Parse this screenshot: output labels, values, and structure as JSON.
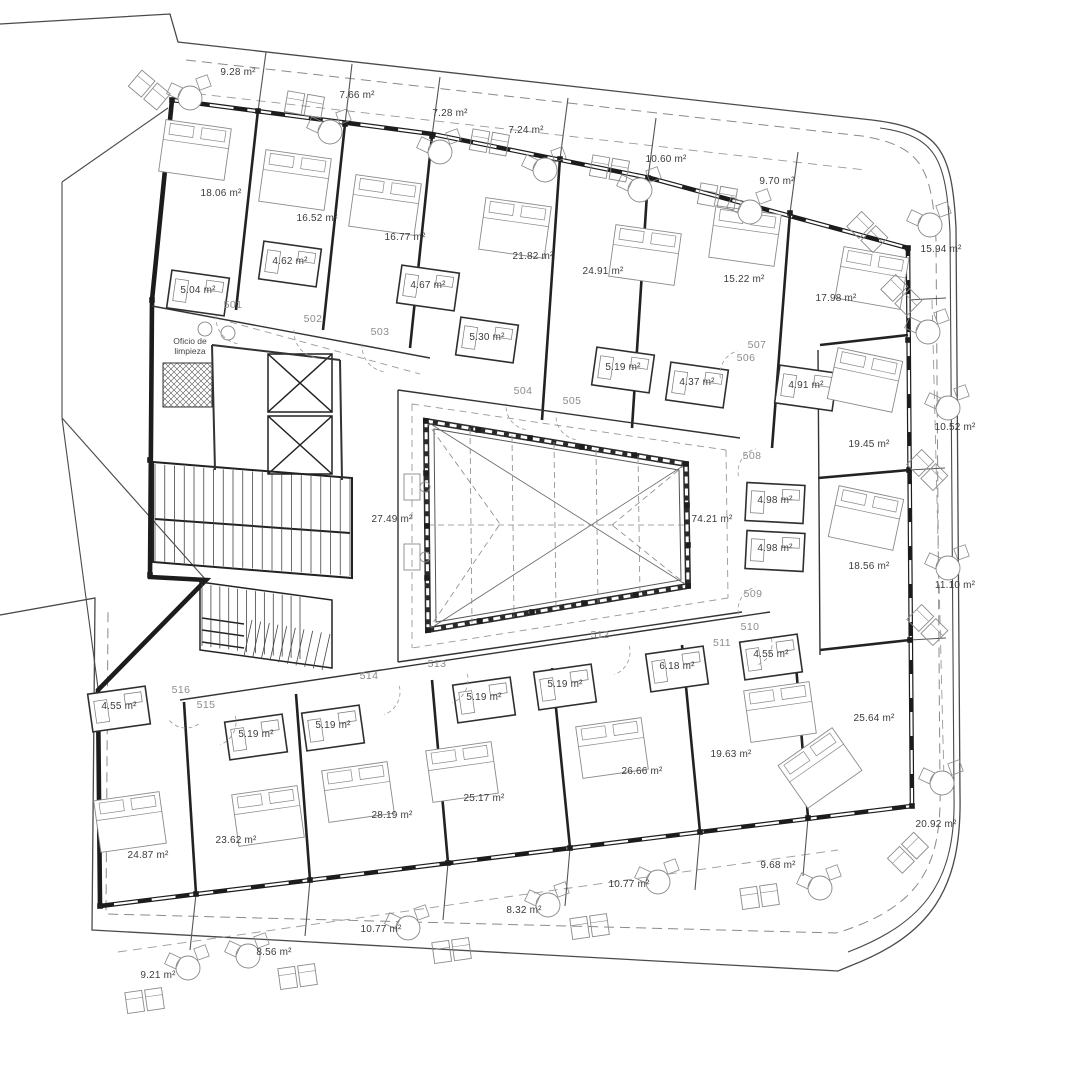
{
  "plan": {
    "canvas": {
      "width": 1072,
      "height": 1080,
      "background": "#ffffff",
      "ink": "#1c1c1c",
      "annotation_color": "#3c3c3c",
      "room_number_color": "#8c8c8c"
    },
    "annotations": {
      "cleaning_room": [
        "Oficio de",
        "limpieza"
      ],
      "area_labels": [
        {
          "t": "9.28 m²",
          "x": 238,
          "y": 75
        },
        {
          "t": "7.66 m²",
          "x": 357,
          "y": 98
        },
        {
          "t": "7.28 m²",
          "x": 450,
          "y": 116
        },
        {
          "t": "7.24 m²",
          "x": 526,
          "y": 133
        },
        {
          "t": "10.60 m²",
          "x": 666,
          "y": 162
        },
        {
          "t": "9.70 m²",
          "x": 777,
          "y": 184
        },
        {
          "t": "15.94 m²",
          "x": 941,
          "y": 252
        },
        {
          "t": "18.06 m²",
          "x": 221,
          "y": 196
        },
        {
          "t": "16.52 m²",
          "x": 317,
          "y": 221
        },
        {
          "t": "16.77 m²",
          "x": 405,
          "y": 240
        },
        {
          "t": "21.82 m²",
          "x": 533,
          "y": 259
        },
        {
          "t": "24.91 m²",
          "x": 603,
          "y": 274
        },
        {
          "t": "15.22 m²",
          "x": 744,
          "y": 282
        },
        {
          "t": "17.98 m²",
          "x": 836,
          "y": 301
        },
        {
          "t": "4.62 m²",
          "x": 290,
          "y": 264
        },
        {
          "t": "5.04 m²",
          "x": 198,
          "y": 293
        },
        {
          "t": "4.67 m²",
          "x": 428,
          "y": 288
        },
        {
          "t": "5.30 m²",
          "x": 487,
          "y": 340
        },
        {
          "t": "5.19 m²",
          "x": 623,
          "y": 370
        },
        {
          "t": "4.37 m²",
          "x": 697,
          "y": 385
        },
        {
          "t": "4.91 m²",
          "x": 806,
          "y": 388
        },
        {
          "t": "19.45 m²",
          "x": 869,
          "y": 447
        },
        {
          "t": "10.52 m²",
          "x": 955,
          "y": 430
        },
        {
          "t": "4.98 m²",
          "x": 775,
          "y": 503
        },
        {
          "t": "4.98 m²",
          "x": 775,
          "y": 551
        },
        {
          "t": "18.56 m²",
          "x": 869,
          "y": 569
        },
        {
          "t": "11.10 m²",
          "x": 955,
          "y": 588
        },
        {
          "t": "27.49 m²",
          "x": 392,
          "y": 522
        },
        {
          "t": "74.21 m²",
          "x": 712,
          "y": 522
        },
        {
          "t": "6.18 m²",
          "x": 677,
          "y": 669
        },
        {
          "t": "4.55 m²",
          "x": 771,
          "y": 657
        },
        {
          "t": "4.55 m²",
          "x": 119,
          "y": 709
        },
        {
          "t": "5.19 m²",
          "x": 256,
          "y": 737
        },
        {
          "t": "5.19 m²",
          "x": 333,
          "y": 728
        },
        {
          "t": "5.19 m²",
          "x": 484,
          "y": 700
        },
        {
          "t": "5.19 m²",
          "x": 565,
          "y": 687
        },
        {
          "t": "25.64 m²",
          "x": 874,
          "y": 721
        },
        {
          "t": "19.63 m²",
          "x": 731,
          "y": 757
        },
        {
          "t": "26.66 m²",
          "x": 642,
          "y": 774
        },
        {
          "t": "25.17 m²",
          "x": 484,
          "y": 801
        },
        {
          "t": "28.19 m²",
          "x": 392,
          "y": 818
        },
        {
          "t": "23.62 m²",
          "x": 236,
          "y": 843
        },
        {
          "t": "24.87 m²",
          "x": 148,
          "y": 858
        },
        {
          "t": "20.92 m²",
          "x": 936,
          "y": 827
        },
        {
          "t": "9.68 m²",
          "x": 778,
          "y": 868
        },
        {
          "t": "10.77 m²",
          "x": 629,
          "y": 887
        },
        {
          "t": "8.32 m²",
          "x": 524,
          "y": 913
        },
        {
          "t": "10.77 m²",
          "x": 381,
          "y": 932
        },
        {
          "t": "8.56 m²",
          "x": 274,
          "y": 955
        },
        {
          "t": "9.21 m²",
          "x": 158,
          "y": 978
        }
      ],
      "room_numbers": [
        {
          "t": "501",
          "x": 233,
          "y": 308
        },
        {
          "t": "502",
          "x": 313,
          "y": 322
        },
        {
          "t": "503",
          "x": 380,
          "y": 335
        },
        {
          "t": "504",
          "x": 523,
          "y": 394
        },
        {
          "t": "505",
          "x": 572,
          "y": 404
        },
        {
          "t": "506",
          "x": 746,
          "y": 361
        },
        {
          "t": "507",
          "x": 757,
          "y": 348
        },
        {
          "t": "508",
          "x": 752,
          "y": 459
        },
        {
          "t": "509",
          "x": 753,
          "y": 597
        },
        {
          "t": "510",
          "x": 750,
          "y": 630
        },
        {
          "t": "511",
          "x": 722,
          "y": 646
        },
        {
          "t": "512",
          "x": 600,
          "y": 638
        },
        {
          "t": "513",
          "x": 437,
          "y": 667
        },
        {
          "t": "514",
          "x": 369,
          "y": 679
        },
        {
          "t": "515",
          "x": 206,
          "y": 708
        },
        {
          "t": "516",
          "x": 181,
          "y": 693
        }
      ]
    },
    "geometry": {
      "paths": [
        {
          "d": "M0,24 L170,14 L178,42 L872,120 C940,128 952,150 956,228 L960,795 C962,890 930,935 850,966 L838,971 L92,930 L95,598 L0,615",
          "s": "#4a4a4a",
          "w": 1.3
        },
        {
          "d": "M880,128 C936,136 946,158 950,232 L954,795 C956,880 926,922 848,952",
          "s": "#4a4a4a",
          "w": 1.1
        },
        {
          "d": "M62,182 L62,418 M62,182 L168,108 M62,418 L206,580 M62,418 L98,688 M0,615 L95,598",
          "s": "#4a4a4a",
          "w": 1.1
        },
        {
          "d": "M186,60 L862,136 C922,146 932,168 936,240 L940,788 C942,868 918,905 846,930 L836,933 L106,914 L108,612",
          "s": "#8a8a8a",
          "w": 1,
          "da": "10 6"
        },
        {
          "d": "M182,92 L865,170 M118,952 L838,850 M932,300 L944,780",
          "s": "#9a9a9a",
          "w": 0.9,
          "da": "9 6"
        },
        {
          "d": "M258,111 L266,52 M345,124 L352,64 M432,136 L440,77 M560,159 L568,98 M648,178 L656,118 M790,213 L798,152 M908,300 L946,298 M909,470 L945,468 M910,640 L946,638 M196,894 L190,950 M310,880 L305,936 M448,863 L443,920 M570,848 L565,906 M700,832 L695,890 M808,818 L803,876",
          "s": "#555555",
          "w": 1.1
        },
        {
          "d": "M172,100 L432,134 L650,178 L908,248 L912,806 L100,906 L98,690 L206,580 L150,577 L152,300 Z",
          "s": "#1c1c1c",
          "w": 4.6
        },
        {
          "d": "M172,100 L432,134 L650,178 L908,248 L912,806 L100,906",
          "s": "#ffffff",
          "w": 2.2,
          "da": "24 14"
        },
        {
          "d": "M258,110 L236,310 M345,124 L323,330 M432,136 L410,348 M560,158 L542,420 M648,178 L632,428 M790,213 L772,448",
          "s": "#222222",
          "w": 2.6
        },
        {
          "d": "M908,335 L820,345 M909,470 L818,478 M910,640 L820,650 M808,818 L795,652 M700,832 L682,645 M570,848 L552,668 M448,863 L432,680 M310,880 L296,694 M196,894 L184,702",
          "s": "#222222",
          "w": 2.6
        },
        {
          "d": "M152,306 L430,358 M818,350 L820,655 M180,700 L770,612 M398,390 L740,438 M742,612 L398,662 M398,390 L398,662",
          "s": "#333333",
          "w": 1.4
        },
        {
          "d": "M412,404 L726,450 M728,598 L412,648 M412,404 L412,648 M726,450 L728,598 M230,322 L420,374",
          "s": "#999999",
          "w": 0.9,
          "da": "7 5"
        },
        {
          "d": "M426,421 L686,464 L688,586 L428,630 Z",
          "s": "#2a2a2a",
          "w": 6
        },
        {
          "d": "M426,421 L686,464 L688,586 L428,630 Z",
          "s": "#ffffff",
          "w": 3,
          "da": "7 5"
        },
        {
          "d": "M434,429 L679,470 L681,580 L436,622 Z",
          "s": "#555555",
          "w": 1
        },
        {
          "d": "M426,421 L688,586 M686,464 L428,630",
          "s": "#666666",
          "w": 0.8
        },
        {
          "d": "M428,525 L686,525 M426,421 L500,524 M428,630 L500,524 M686,464 L612,525 M688,586 L612,525 M470,428 L472,623 M512,435 L514,617 M554,442 L556,610 M596,449 L598,603 M638,456 L640,596",
          "s": "#888888",
          "w": 0.8,
          "da": "6 4"
        },
        {
          "d": "M153,462 L352,478 L352,578 L153,562 Z M155,519 L350,533",
          "s": "#222222",
          "w": 2
        },
        {
          "d": "M200,582 L332,600 L332,668 L200,650 Z M202,618 L244,624 M202,630 L244,636 M202,642 L244,648",
          "s": "#222222",
          "w": 1.5
        },
        {
          "d": "M268,354 L332,354 L332,412 L268,412 Z M268,354 L332,412 M332,354 L268,412 M268,416 L332,416 L332,474 L268,474 Z M268,416 L332,474 M332,416 L268,474",
          "s": "#222222",
          "w": 1.5
        },
        {
          "d": "M212,345 L340,360 M212,345 L215,470 M340,360 L342,480",
          "s": "#333333",
          "w": 2
        },
        {
          "d": "M163,363 L212,363 L212,407 L163,407 Z",
          "s": "#333333",
          "w": 1,
          "f": "url(#xh)"
        }
      ],
      "stairs": [
        {
          "a": [
            155,
            464
          ],
          "b": [
            350,
            479
          ],
          "c": [
            350,
            576
          ],
          "e": [
            155,
            561
          ],
          "n": 20
        },
        {
          "a": [
            202,
            584
          ],
          "b": [
            300,
            597
          ],
          "c": [
            300,
            659
          ],
          "e": [
            202,
            646
          ],
          "n": 11
        },
        {
          "a": [
            252,
            620
          ],
          "b": [
            330,
            634
          ],
          "c": [
            322,
            670
          ],
          "e": [
            244,
            656
          ],
          "n": 9
        }
      ],
      "posts": [
        [
          426,
          421
        ],
        [
          478,
          430
        ],
        [
          530,
          438
        ],
        [
          582,
          447
        ],
        [
          634,
          455
        ],
        [
          686,
          464
        ],
        [
          687,
          505
        ],
        [
          688,
          545
        ],
        [
          688,
          586
        ],
        [
          636,
          595
        ],
        [
          584,
          603
        ],
        [
          532,
          612
        ],
        [
          480,
          621
        ],
        [
          428,
          630
        ],
        [
          427,
          578
        ],
        [
          427,
          526
        ],
        [
          426,
          473
        ],
        [
          258,
          111
        ],
        [
          345,
          124
        ],
        [
          432,
          136
        ],
        [
          560,
          159
        ],
        [
          648,
          178
        ],
        [
          790,
          213
        ],
        [
          908,
          340
        ],
        [
          909,
          470
        ],
        [
          910,
          640
        ],
        [
          196,
          894
        ],
        [
          310,
          880
        ],
        [
          448,
          863
        ],
        [
          570,
          848
        ],
        [
          700,
          832
        ],
        [
          808,
          818
        ],
        [
          152,
          300
        ],
        [
          150,
          460
        ],
        [
          150,
          575
        ],
        [
          172,
          100
        ],
        [
          908,
          248
        ],
        [
          912,
          806
        ],
        [
          100,
          906
        ]
      ],
      "beds": [
        [
          195,
          150,
          8
        ],
        [
          295,
          180,
          8
        ],
        [
          385,
          205,
          8
        ],
        [
          515,
          228,
          8
        ],
        [
          645,
          255,
          8
        ],
        [
          745,
          236,
          8
        ],
        [
          872,
          278,
          10
        ],
        [
          865,
          380,
          12
        ],
        [
          866,
          518,
          12
        ],
        [
          820,
          768,
          -35
        ],
        [
          780,
          712,
          -8
        ],
        [
          612,
          748,
          -8
        ],
        [
          462,
          772,
          -8
        ],
        [
          358,
          792,
          -8
        ],
        [
          268,
          816,
          -8
        ],
        [
          130,
          822,
          -8
        ]
      ],
      "tables": [
        [
          190,
          98
        ],
        [
          330,
          132
        ],
        [
          440,
          152
        ],
        [
          545,
          170
        ],
        [
          640,
          190
        ],
        [
          750,
          212
        ],
        [
          930,
          225
        ],
        [
          928,
          332
        ],
        [
          948,
          408
        ],
        [
          948,
          568
        ],
        [
          942,
          783
        ],
        [
          820,
          888
        ],
        [
          658,
          882
        ],
        [
          548,
          905
        ],
        [
          408,
          928
        ],
        [
          248,
          956
        ],
        [
          188,
          968
        ]
      ],
      "loungers": [
        [
          150,
          90,
          40
        ],
        [
          305,
          104,
          10
        ],
        [
          490,
          142,
          10
        ],
        [
          610,
          168,
          10
        ],
        [
          718,
          196,
          10
        ],
        [
          868,
          232,
          45
        ],
        [
          902,
          295,
          45
        ],
        [
          928,
          470,
          45
        ],
        [
          928,
          625,
          45
        ],
        [
          908,
          852,
          -45
        ],
        [
          760,
          896,
          -8
        ],
        [
          590,
          926,
          -8
        ],
        [
          452,
          950,
          -8
        ],
        [
          298,
          976,
          -8
        ],
        [
          145,
          1000,
          -8
        ]
      ],
      "pods": [
        [
          198,
          293,
          8
        ],
        [
          290,
          264,
          8
        ],
        [
          428,
          288,
          8
        ],
        [
          487,
          340,
          8
        ],
        [
          623,
          370,
          8
        ],
        [
          697,
          385,
          8
        ],
        [
          806,
          388,
          8
        ],
        [
          775,
          503,
          3
        ],
        [
          775,
          551,
          3
        ],
        [
          677,
          669,
          -8
        ],
        [
          771,
          657,
          -8
        ],
        [
          119,
          709,
          -8
        ],
        [
          256,
          737,
          -8
        ],
        [
          333,
          728,
          -8
        ],
        [
          484,
          700,
          -8
        ],
        [
          565,
          687,
          -8
        ]
      ],
      "desks": [
        [
          412,
          487
        ],
        [
          412,
          557
        ]
      ],
      "circles": [
        [
          205,
          329,
          7
        ],
        [
          228,
          333,
          7
        ]
      ],
      "arcs": [
        [
          242,
          318,
          26,
          100
        ],
        [
          320,
          332,
          26,
          100
        ],
        [
          388,
          346,
          26,
          100
        ],
        [
          530,
          406,
          24,
          100
        ],
        [
          580,
          416,
          24,
          100
        ],
        [
          744,
          374,
          24,
          170
        ],
        [
          762,
          472,
          24,
          170
        ],
        [
          762,
          610,
          24,
          170
        ],
        [
          750,
          644,
          22,
          -15
        ],
        [
          606,
          652,
          24,
          -15
        ],
        [
          444,
          680,
          24,
          -15
        ],
        [
          376,
          692,
          24,
          -15
        ],
        [
          212,
          722,
          24,
          -15
        ],
        [
          186,
          706,
          22,
          55
        ]
      ]
    }
  }
}
